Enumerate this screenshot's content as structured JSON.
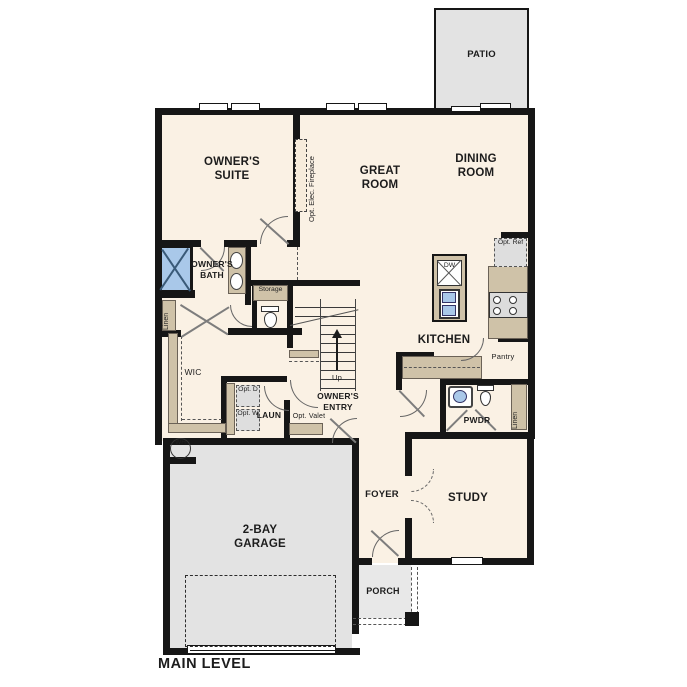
{
  "plan": {
    "title": "MAIN LEVEL",
    "colors": {
      "floor": "#FAF1E4",
      "wall": "#161616",
      "cabinetry_tan": "#CFC2A8",
      "concrete_gray": "#E3E3E3",
      "fixture_blue": "#A9C8E9"
    },
    "rooms": {
      "patio": "PATIO",
      "owners_suite": "OWNER'S SUITE",
      "great_room": "GREAT ROOM",
      "dining_room": "DINING ROOM",
      "owners_bath": "OWNER'S BATH",
      "wic": "WIC",
      "laundry": "LAUN",
      "owners_entry": "OWNER'S ENTRY",
      "kitchen": "KITCHEN",
      "pantry": "Pantry",
      "powder_room": "PWDR",
      "foyer": "FOYER",
      "study": "STUDY",
      "garage": "2-BAY GARAGE",
      "porch": "PORCH"
    },
    "annotations": {
      "opt_fireplace": "Opt. Elec. Fireplace",
      "linen_bath": "Linen",
      "linen_hall": "Linen",
      "storage": "Storage",
      "opt_dryer": "Opt. D",
      "opt_washer": "Opt. W",
      "opt_valet": "Opt. Valet",
      "stairs_up": "Up",
      "dishwasher": "DW",
      "opt_refrigerator": "Opt. Ref",
      "water_heater": "WH"
    },
    "fixtures": [
      "shower-icon",
      "double-vanity-icon",
      "toilet-icon",
      "island-sink-icon",
      "range-icon",
      "stairs-icon",
      "garage-door-icon",
      "window-icon",
      "door-swing-icon"
    ]
  }
}
